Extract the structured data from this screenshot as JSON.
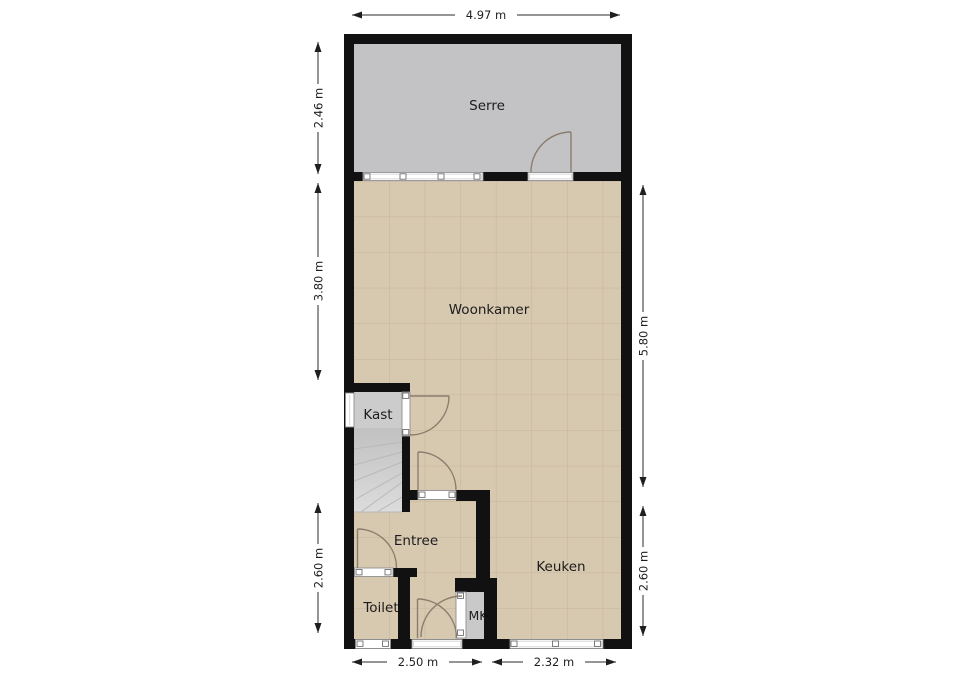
{
  "plan": {
    "rooms": {
      "serre": "Serre",
      "woonkamer": "Woonkamer",
      "kast": "Kast",
      "entree": "Entree",
      "toilet": "Toilet",
      "mk": "MK",
      "keuken": "Keuken"
    },
    "dimensions": {
      "top": "4.97 m",
      "left_top": "2.46 m",
      "left_middle": "3.80 m",
      "left_bottom": "2.60 m",
      "right_top": "5.80 m",
      "right_bottom": "2.60 m",
      "bottom_left": "2.50 m",
      "bottom_right": "2.32 m"
    },
    "colors": {
      "wall": "#111111",
      "serre_floor": "#c3c3c5",
      "tile_floor": "#d7c8b0",
      "tile_grid": "#c3b299",
      "closet_floor": "#cccccc",
      "stairs_top": "#c1c1c1",
      "stairs_bottom": "#dcdcdc",
      "mk_floor": "#c9c9c9",
      "door_arc": "#8a7d6e",
      "window_frame": "#8f8f8f"
    }
  }
}
